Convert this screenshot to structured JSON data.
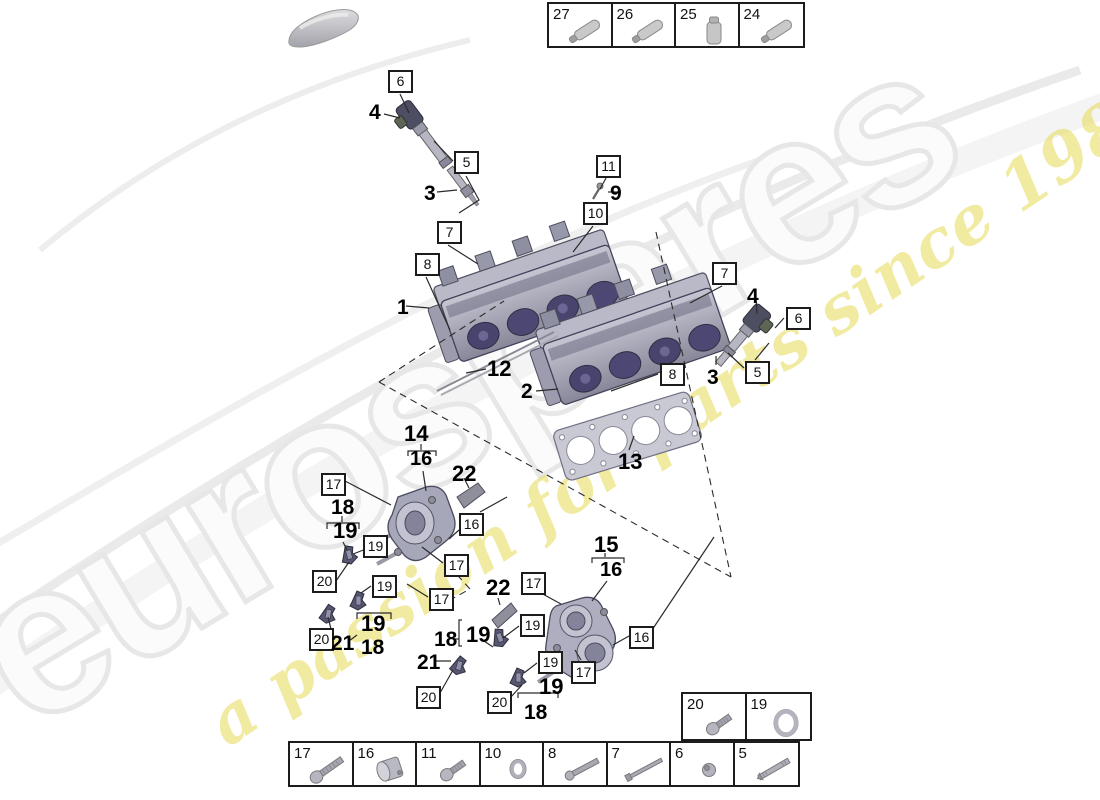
{
  "watermark": {
    "brand": "eurospares",
    "tagline": "a passion for parts since 1985",
    "brand_color": "#e7e7e7",
    "tagline_color": "#e7da55"
  },
  "legend_top": {
    "cells": [
      {
        "num": "27",
        "icon": "sealant-tube"
      },
      {
        "num": "26",
        "icon": "sealant-tube"
      },
      {
        "num": "25",
        "icon": "fluid-bottle"
      },
      {
        "num": "24",
        "icon": "sealant-tube"
      }
    ]
  },
  "legend_side": {
    "cells": [
      {
        "num": "20",
        "icon": "pan-screw"
      },
      {
        "num": "19",
        "icon": "o-ring-large"
      }
    ]
  },
  "legend_bottom": {
    "cells": [
      {
        "num": "17",
        "icon": "pan-screw-long"
      },
      {
        "num": "16",
        "icon": "cap-plug"
      },
      {
        "num": "11",
        "icon": "pan-screw"
      },
      {
        "num": "10",
        "icon": "seal-ring-small"
      },
      {
        "num": "8",
        "icon": "long-bolt"
      },
      {
        "num": "7",
        "icon": "long-stud"
      },
      {
        "num": "6",
        "icon": "small-plug"
      },
      {
        "num": "5",
        "icon": "stud-bolt"
      }
    ]
  },
  "callouts": [
    {
      "num": "6",
      "x": 388,
      "y": 70
    },
    {
      "num": "5",
      "x": 454,
      "y": 151
    },
    {
      "num": "11",
      "x": 596,
      "y": 155
    },
    {
      "num": "10",
      "x": 583,
      "y": 202
    },
    {
      "num": "7",
      "x": 437,
      "y": 221
    },
    {
      "num": "8",
      "x": 415,
      "y": 253
    },
    {
      "num": "7",
      "x": 712,
      "y": 262
    },
    {
      "num": "6",
      "x": 786,
      "y": 307
    },
    {
      "num": "5",
      "x": 745,
      "y": 361
    },
    {
      "num": "8",
      "x": 660,
      "y": 363
    },
    {
      "num": "17",
      "x": 321,
      "y": 473
    },
    {
      "num": "16",
      "x": 459,
      "y": 513
    },
    {
      "num": "19",
      "x": 363,
      "y": 535
    },
    {
      "num": "17",
      "x": 444,
      "y": 554
    },
    {
      "num": "20",
      "x": 312,
      "y": 570
    },
    {
      "num": "19",
      "x": 372,
      "y": 575
    },
    {
      "num": "17",
      "x": 429,
      "y": 588
    },
    {
      "num": "20",
      "x": 309,
      "y": 628
    },
    {
      "num": "17",
      "x": 521,
      "y": 572
    },
    {
      "num": "19",
      "x": 520,
      "y": 614
    },
    {
      "num": "16",
      "x": 629,
      "y": 626
    },
    {
      "num": "19",
      "x": 538,
      "y": 651
    },
    {
      "num": "17",
      "x": 571,
      "y": 661
    },
    {
      "num": "20",
      "x": 416,
      "y": 686
    },
    {
      "num": "20",
      "x": 487,
      "y": 691
    }
  ],
  "part_labels": [
    {
      "num": "4",
      "x": 369,
      "y": 102,
      "s": 21
    },
    {
      "num": "3",
      "x": 424,
      "y": 183,
      "s": 21
    },
    {
      "num": "9",
      "x": 610,
      "y": 183,
      "s": 21
    },
    {
      "num": "1",
      "x": 397,
      "y": 297,
      "s": 21
    },
    {
      "num": "12",
      "x": 487,
      "y": 358,
      "s": 22
    },
    {
      "num": "2",
      "x": 521,
      "y": 381,
      "s": 21
    },
    {
      "num": "4",
      "x": 747,
      "y": 286,
      "s": 21
    },
    {
      "num": "3",
      "x": 707,
      "y": 367,
      "s": 21
    },
    {
      "num": "13",
      "x": 618,
      "y": 451,
      "s": 22
    },
    {
      "num": "14",
      "x": 404,
      "y": 423,
      "s": 22
    },
    {
      "num": "16",
      "x": 410,
      "y": 449,
      "s": 20
    },
    {
      "num": "22",
      "x": 452,
      "y": 463,
      "s": 22
    },
    {
      "num": "18",
      "x": 331,
      "y": 497,
      "s": 21
    },
    {
      "num": "19",
      "x": 333,
      "y": 520,
      "s": 22
    },
    {
      "num": "15",
      "x": 594,
      "y": 534,
      "s": 22
    },
    {
      "num": "16",
      "x": 600,
      "y": 560,
      "s": 20
    },
    {
      "num": "22",
      "x": 486,
      "y": 577,
      "s": 22
    },
    {
      "num": "19",
      "x": 361,
      "y": 613,
      "s": 22
    },
    {
      "num": "18",
      "x": 361,
      "y": 637,
      "s": 21
    },
    {
      "num": "21",
      "x": 331,
      "y": 633,
      "s": 21
    },
    {
      "num": "18",
      "x": 434,
      "y": 629,
      "s": 21
    },
    {
      "num": "19",
      "x": 466,
      "y": 624,
      "s": 22
    },
    {
      "num": "21",
      "x": 417,
      "y": 652,
      "s": 21
    },
    {
      "num": "19",
      "x": 539,
      "y": 676,
      "s": 22
    },
    {
      "num": "18",
      "x": 524,
      "y": 702,
      "s": 21
    }
  ]
}
